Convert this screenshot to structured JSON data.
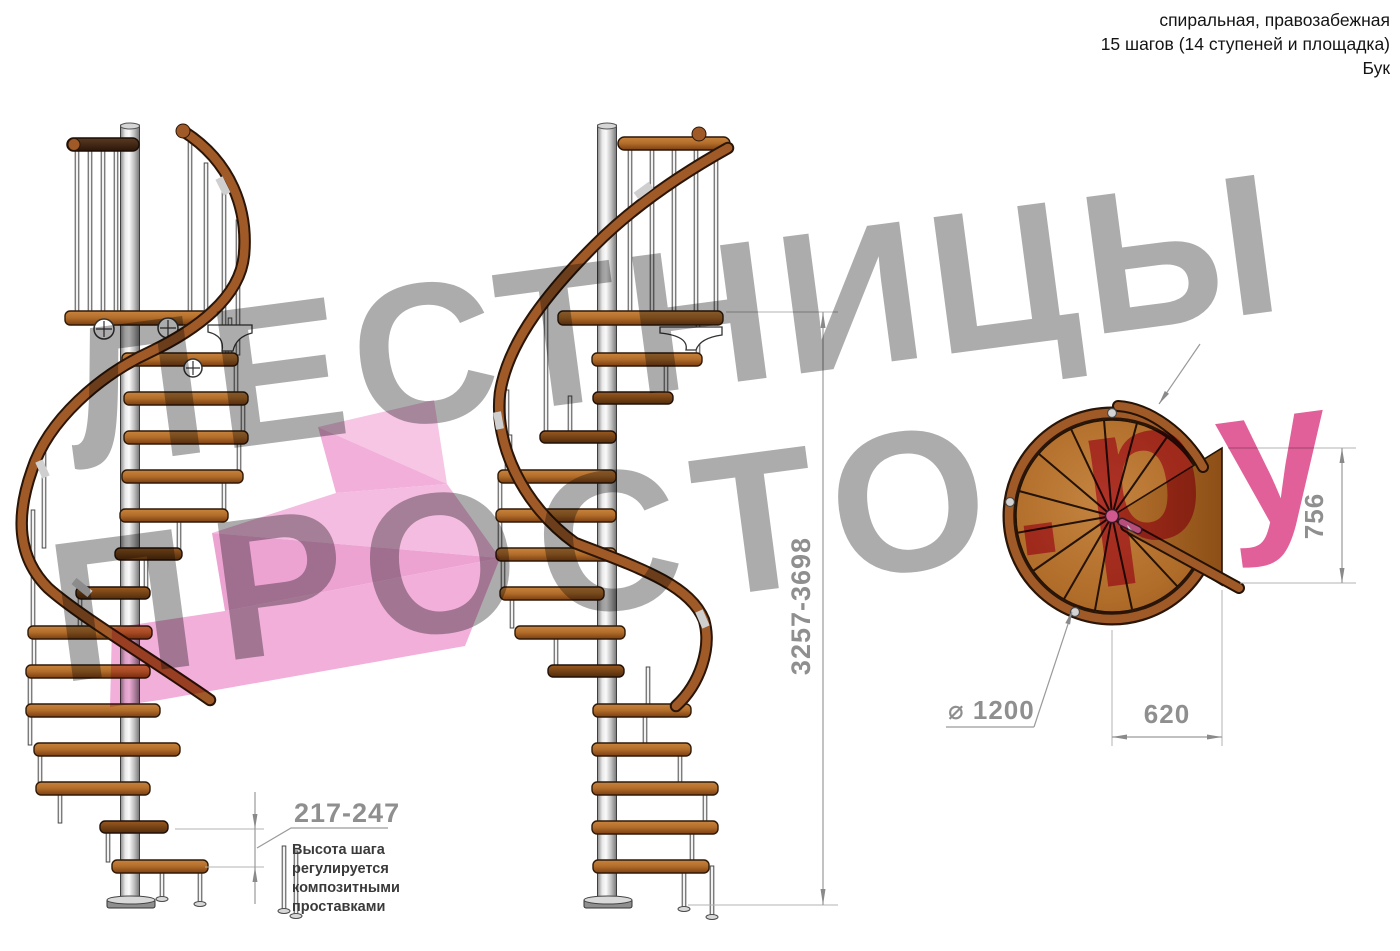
{
  "header": {
    "line1": "спиральная, правозабежная",
    "line2": "15 шагов (14 ступеней и площадка)",
    "line3": "Бук"
  },
  "watermark": {
    "line1": "ЛЕСТНИЦЫ",
    "line2_gray": "ПРОСТО",
    "line2_pink": ".ру"
  },
  "dimensions": {
    "total_height": "3257-3698",
    "step_height": "217-247",
    "step_height_note": [
      "Высота шага",
      "регулируется",
      "композитными",
      "проставками"
    ],
    "plan_landing_width": "620",
    "plan_landing_depth": "756",
    "plan_diameter": "⌀ 1200"
  },
  "colors": {
    "wood": "#b06c29",
    "wood_dark": "#7c3f12",
    "handrail": "#a05a28",
    "top_rail_walnut": "#4a2b16",
    "metal_pole": "#c9c9c9",
    "dimension_gray": "#8f8f8f",
    "note_text": "#3a3a3a",
    "watermark_gray": "#acacac",
    "watermark_pink": "#e26099",
    "logo_arrow_pink": "#f1afda"
  }
}
